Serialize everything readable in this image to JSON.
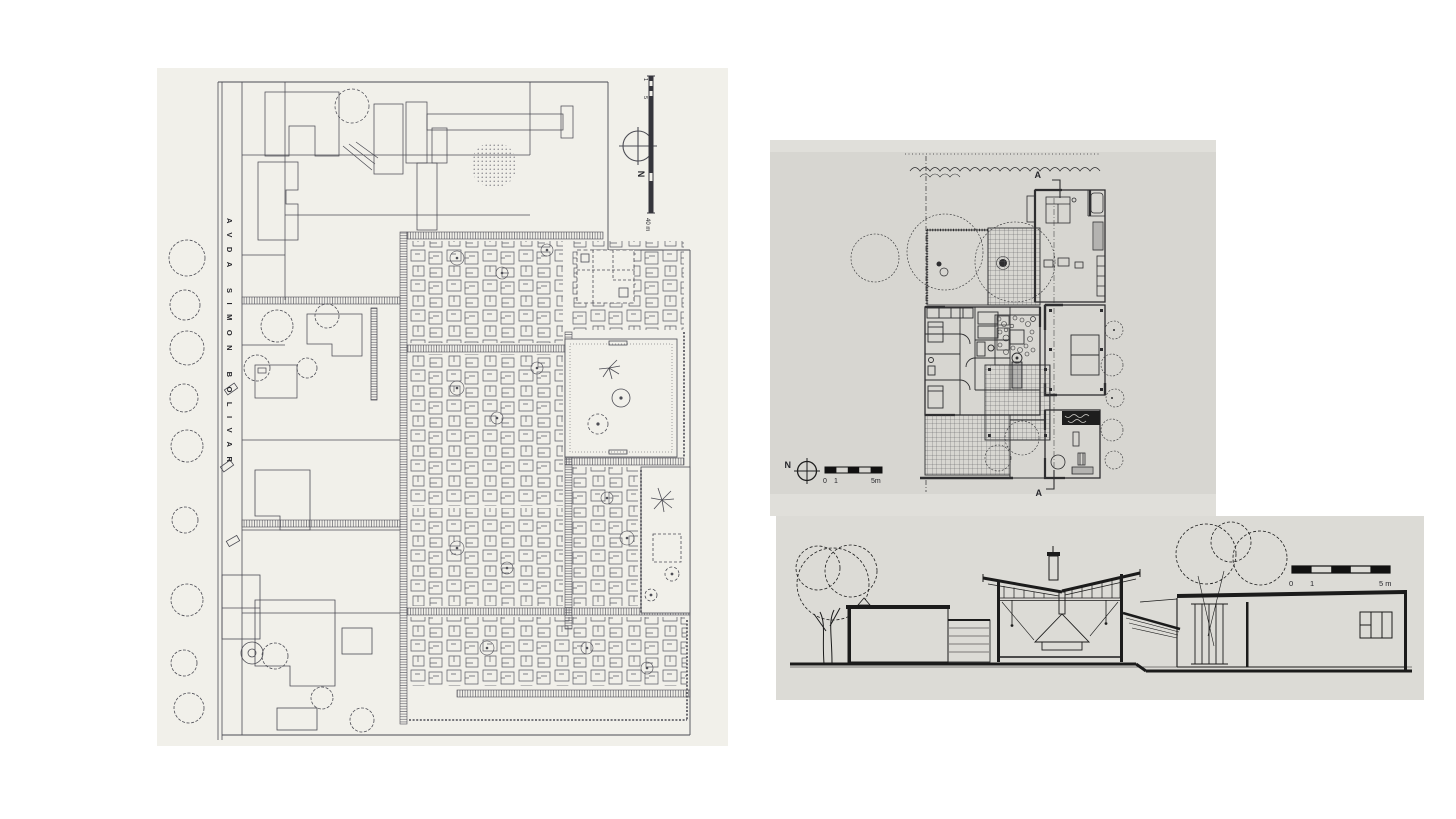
{
  "figures": {
    "site_plan": {
      "label": "housing site plan",
      "street_label": "AVDA  SIMON  BOLIVAR",
      "north_label": "N",
      "scale_bar": {
        "tick_top": "1",
        "tick_mid": "5",
        "tick_bottom": "40 m"
      },
      "colors": {
        "paper": "#f1f0ea",
        "ink": "#4c4c54"
      }
    },
    "floor_plan": {
      "label": "house floor plan",
      "north_label": "N",
      "section_marker_top": "A",
      "section_marker_bottom": "A",
      "scale_bar": {
        "tick_0": "0",
        "tick_1": "1",
        "tick_5": "5m"
      },
      "colors": {
        "paper": "#d7d6d1",
        "ink": "#2e2e30"
      }
    },
    "section": {
      "label": "section A-A",
      "scale_bar": {
        "tick_0": "0",
        "tick_1": "1",
        "tick_5": "5 m"
      },
      "colors": {
        "paper": "#dcdbd6",
        "ink": "#1b1b1b"
      }
    }
  }
}
